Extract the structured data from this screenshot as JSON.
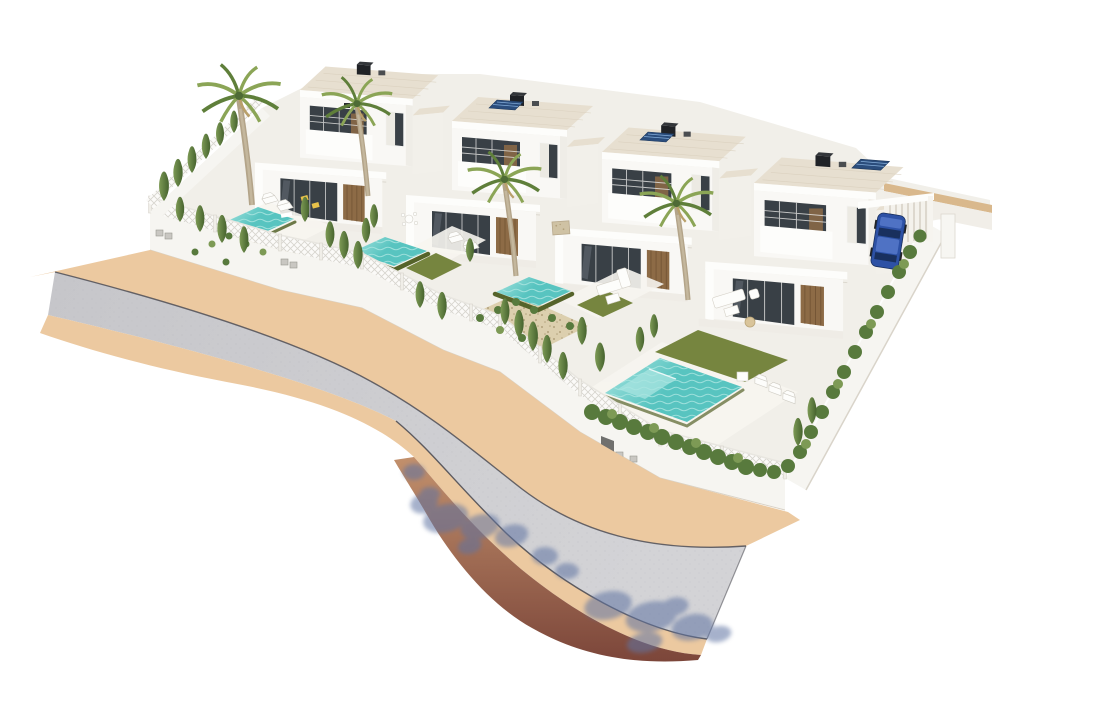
{
  "meta": {
    "title": "Aerial 3D architectural rendering of four new-build villas with private pools",
    "description": "Computer-generated exterior visualisation seen from above: a row of four modern white two-storey flat-roofed villas, each with a walled garden, turquoise swimming pool, lawn, gravel beds, cypress trees and palm trees, enclosed by white lattice fencing. A grey asphalt road with sand-coloured sidewalks runs diagonally along the lower left and curves down to the bottom right, where blue tree shadows fall across the road and a dark red-brown embankment edges the plot. A blue SUV is parked in a carport beside the fourth villa."
  },
  "scene": {
    "villas": [
      {
        "name": "villa-1",
        "position": "far left",
        "storeys": 2,
        "roof": "flat roof with black chimney",
        "garden": [
          "small turquoise pool",
          "gravel bed with shrubs",
          "two sun loungers",
          "two yellow deck chairs",
          "outdoor dining set"
        ]
      },
      {
        "name": "villa-2",
        "position": "centre left",
        "storeys": 2,
        "roof": "flat roof with chimney and solar panel",
        "garden": [
          "turquoise pool with dark overflow edge",
          "artificial lawn",
          "two sun loungers"
        ]
      },
      {
        "name": "villa-3",
        "position": "centre right",
        "storeys": 2,
        "roof": "flat roof with chimney and solar panel",
        "garden": [
          "turquoise pool with dark overflow edge",
          "lawn",
          "large gravel bed with shrubs",
          "white lounge sofa set",
          "stone barbecue block"
        ]
      },
      {
        "name": "villa-4",
        "position": "right, at street corner",
        "storeys": 2,
        "roof": "flat roof with chimney and solar panel",
        "garden": [
          "large turquoise pool with tanning shelf",
          "large lawn",
          "white garden sofa with wicker pouf",
          "three sun loungers and side table",
          "boundary hedge"
        ],
        "extras": [
          "carport with blue SUV parked against boundary wall"
        ]
      }
    ],
    "architecture": {
      "style": "modern Mediterranean new-build",
      "walls": "white render",
      "windows": "dark glazing with white frames",
      "doors": "vertical wood slat panels",
      "balconies": "recessed with white parapets"
    },
    "vegetation": {
      "palm_trees": 4,
      "cypress_trees": 30,
      "hedge_rows": 2,
      "shrub_beds": 2
    },
    "street": {
      "surface": "grey asphalt",
      "sidewalk": "sand-coloured paving",
      "alignment": "diagonal from upper left, curving down to lower right",
      "details": [
        "dark kerb lines",
        "blue tree shadows cast over road and embankment",
        "dark red-brown embankment along bottom edge",
        "grey pedestrian gate and utility meter boxes in boundary wall"
      ]
    },
    "pools": [
      {
        "villa": 1,
        "size": "small"
      },
      {
        "villa": 2,
        "size": "small"
      },
      {
        "villa": 3,
        "size": "small"
      },
      {
        "villa": 4,
        "size": "large",
        "loungers": 3
      }
    ],
    "car": {
      "type": "SUV",
      "colour": "blue",
      "location": "carport beside villa 4"
    }
  },
  "colors": {
    "bg": "#ffffff",
    "plot": "#f1efe9",
    "terrace": "#f7f5f0",
    "road": "#c6c6ca",
    "roadLight": "#d3d3d6",
    "walk": "#ecc9a0",
    "curb": "#45454e",
    "slope": "#c2906c",
    "slopeDark": "#7c463a",
    "shadow": "#5f73a2",
    "villa": "#f9f8f5",
    "villaShade": "#e7e3da",
    "fascia": "#fdfdfb",
    "roof": "#e7dfd0",
    "roofLine": "#d8cebc",
    "glass": "#394046",
    "frame": "#f4f4f2",
    "wood": "#8d6b46",
    "woodDark": "#6b4e2f",
    "water": "#58c4c0",
    "waterLight": "#a8e4e0",
    "poolEdge": "#55632a",
    "lawn": "#76853f",
    "gravel": "#dccfae",
    "gravelDot": "#b2a17c",
    "hedge": "#587a3d",
    "cypressDark": "#46632e",
    "cypressLight": "#7d9a55",
    "palmGreen": "#8ba556",
    "palmDark": "#5f7f3a",
    "trunk": "#b3a489",
    "fence": "#f6f5f1",
    "lattice": "#d7d5cf",
    "wallTan": "#d9b88c",
    "solar": "#2b4d7c",
    "solarLine": "#8cb6e2",
    "car": "#2d51a5",
    "carDark": "#19305e",
    "carLight": "#4f72c4",
    "yellow": "#e8c24a",
    "stone": "#cfc2a4"
  }
}
